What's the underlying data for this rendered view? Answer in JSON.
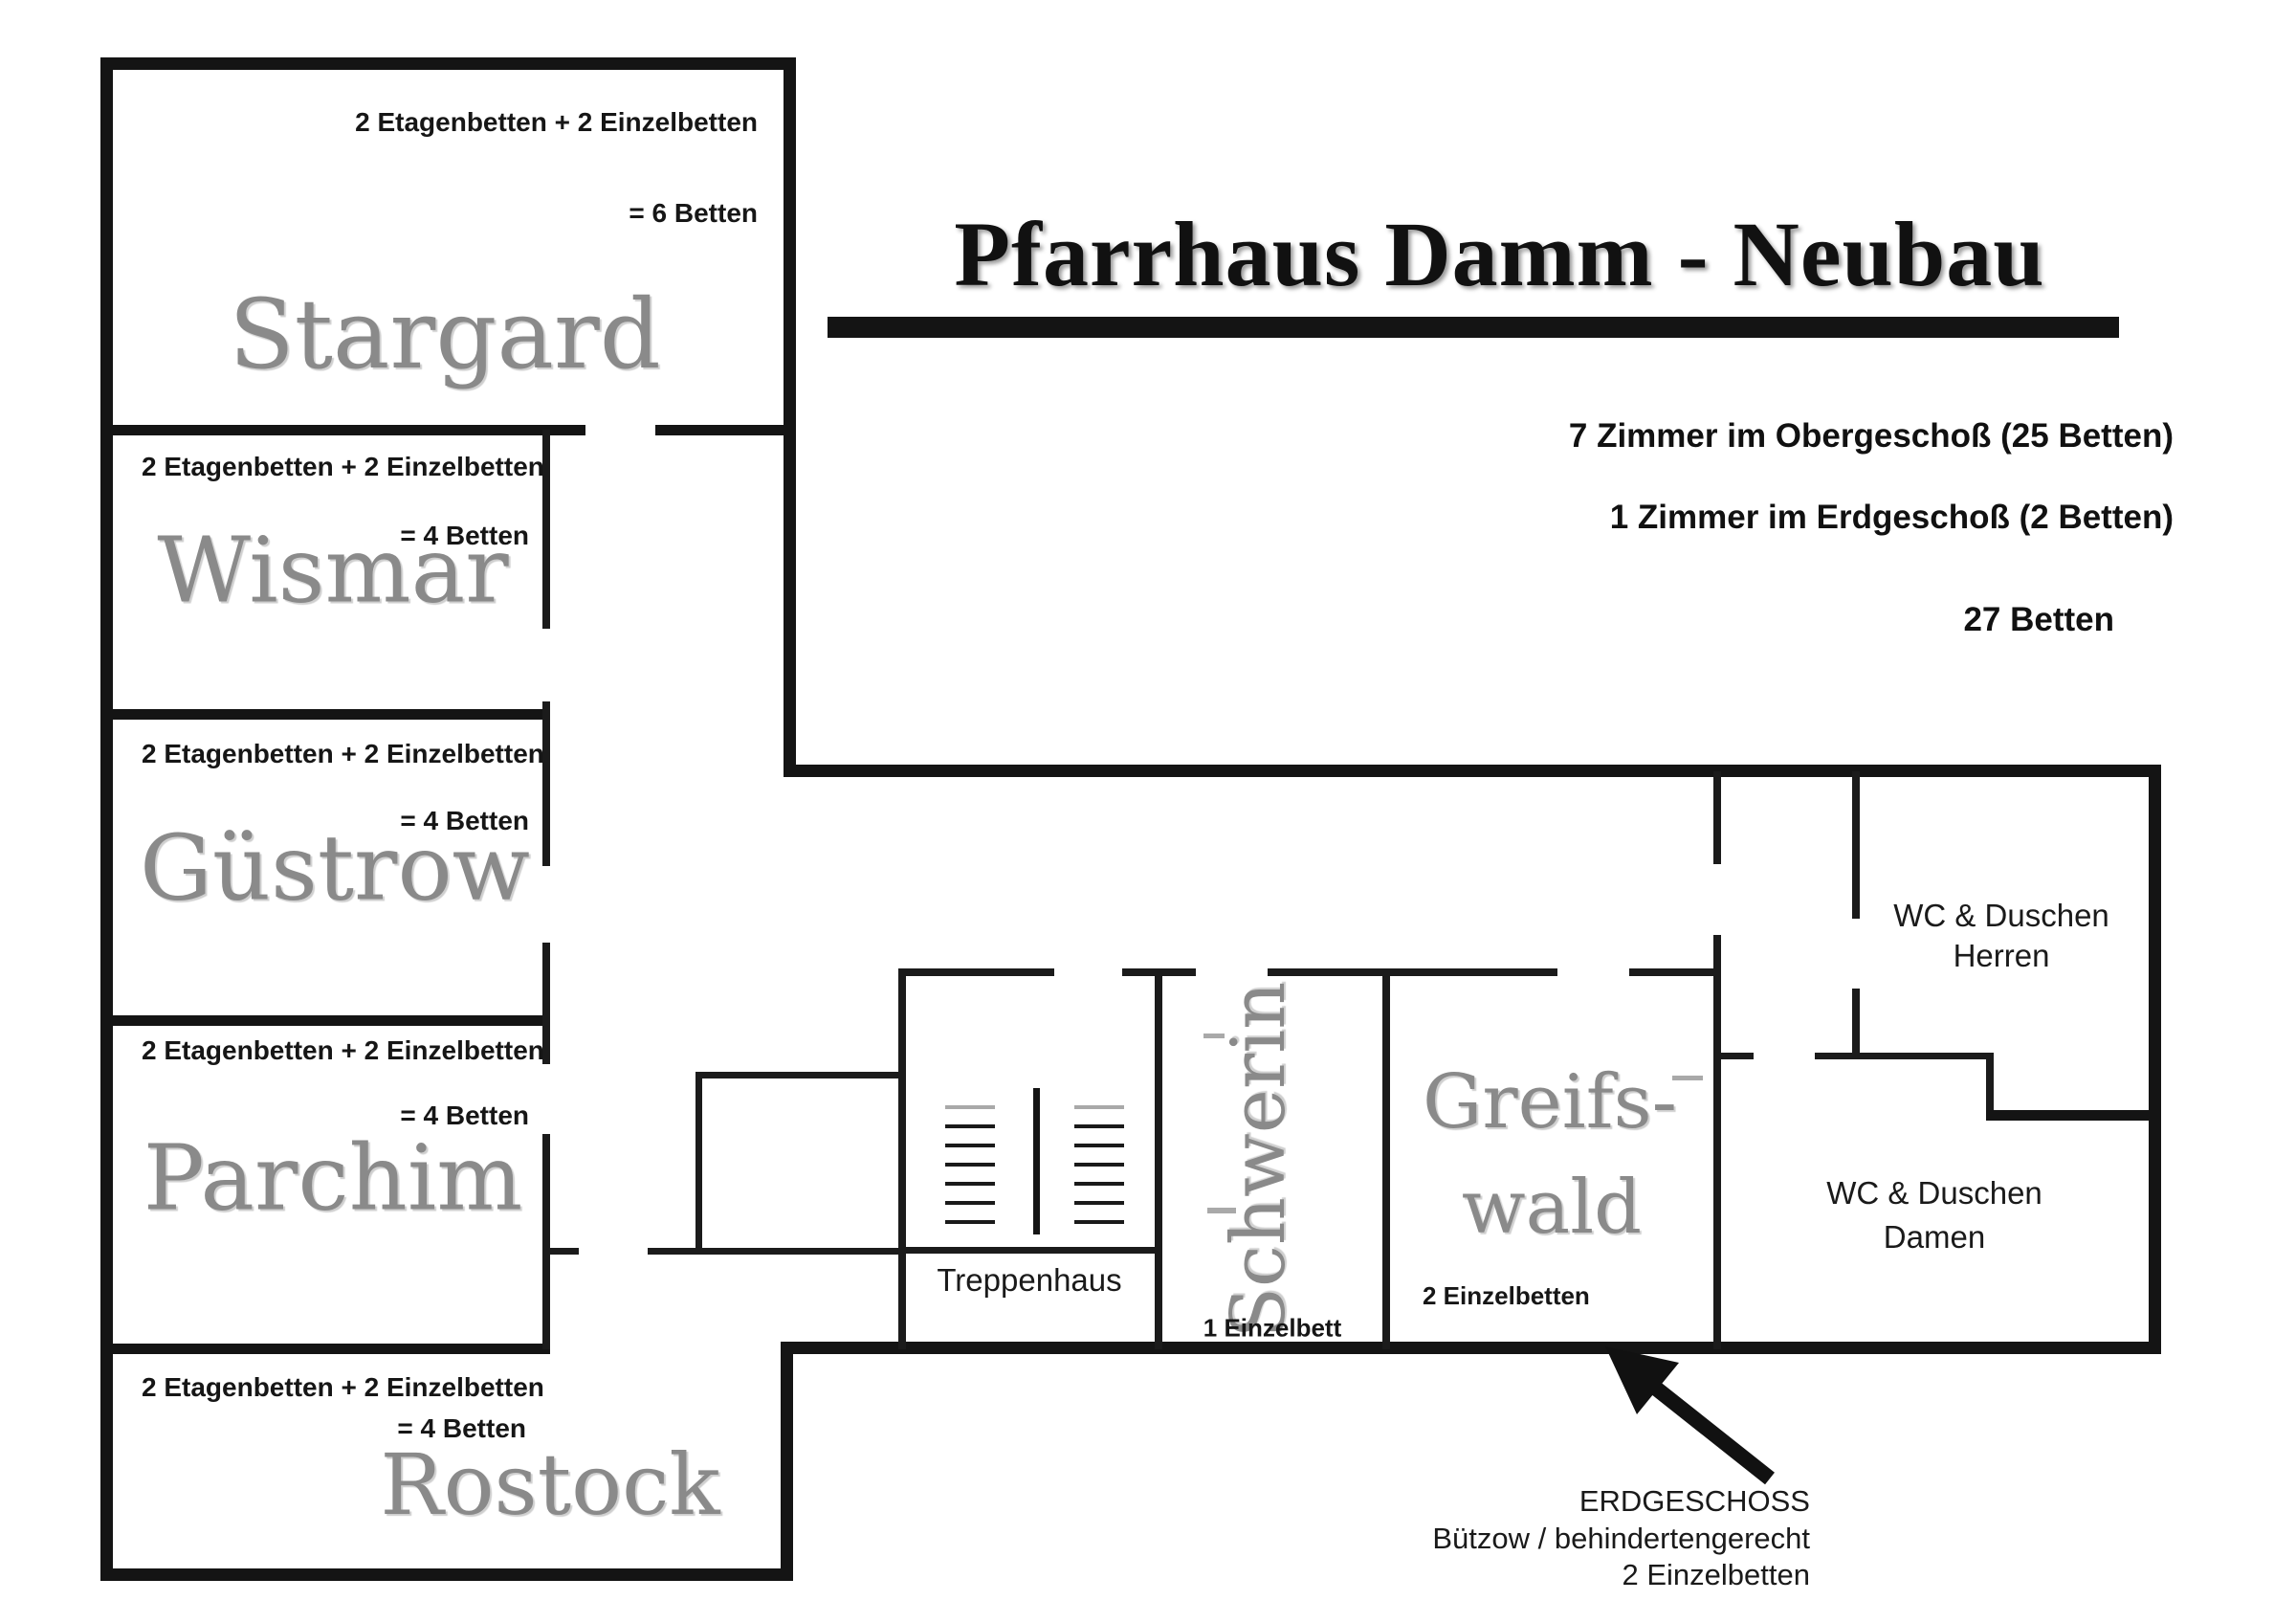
{
  "title": "Pfarrhaus Damm - Neubau",
  "summary": {
    "line1": "7 Zimmer im Obergeschoß (25 Betten)",
    "line2": "1 Zimmer im Erdgeschoß (2 Betten)",
    "line3": "27 Betten"
  },
  "rooms": {
    "stargard": {
      "name": "Stargard",
      "beds": "2 Etagenbetten + 2 Einzelbetten",
      "total": "= 6 Betten"
    },
    "wismar": {
      "name": "Wismar",
      "beds": "2 Etagenbetten + 2 Einzelbetten",
      "total": "= 4 Betten"
    },
    "guestrow": {
      "name": "Güstrow",
      "beds": "2 Etagenbetten + 2 Einzelbetten",
      "total": "= 4 Betten"
    },
    "parchim": {
      "name": "Parchim",
      "beds": "2 Etagenbetten + 2 Einzelbetten",
      "total": "= 4 Betten"
    },
    "rostock": {
      "name": "Rostock",
      "beds": "2 Etagenbetten + 2 Einzelbetten",
      "total": "= 4 Betten"
    },
    "schwerin": {
      "name": "Schwerin",
      "beds": "1 Einzelbett"
    },
    "greifswald": {
      "name_line1": "Greifs-",
      "name_line2": "wald",
      "beds": "2 Einzelbetten"
    },
    "treppenhaus": {
      "name": "Treppenhaus"
    }
  },
  "wc": {
    "herren_line1": "WC & Duschen",
    "herren_line2": "Herren",
    "damen_line1": "WC & Duschen",
    "damen_line2": "Damen"
  },
  "annotation": {
    "line1": "ERDGESCHOSS",
    "line2": "Bützow / behindertengerecht",
    "line3": "2 Einzelbetten"
  },
  "colors": {
    "wall": "#141414",
    "room_label": "#8a8a8a",
    "text": "#111111"
  }
}
